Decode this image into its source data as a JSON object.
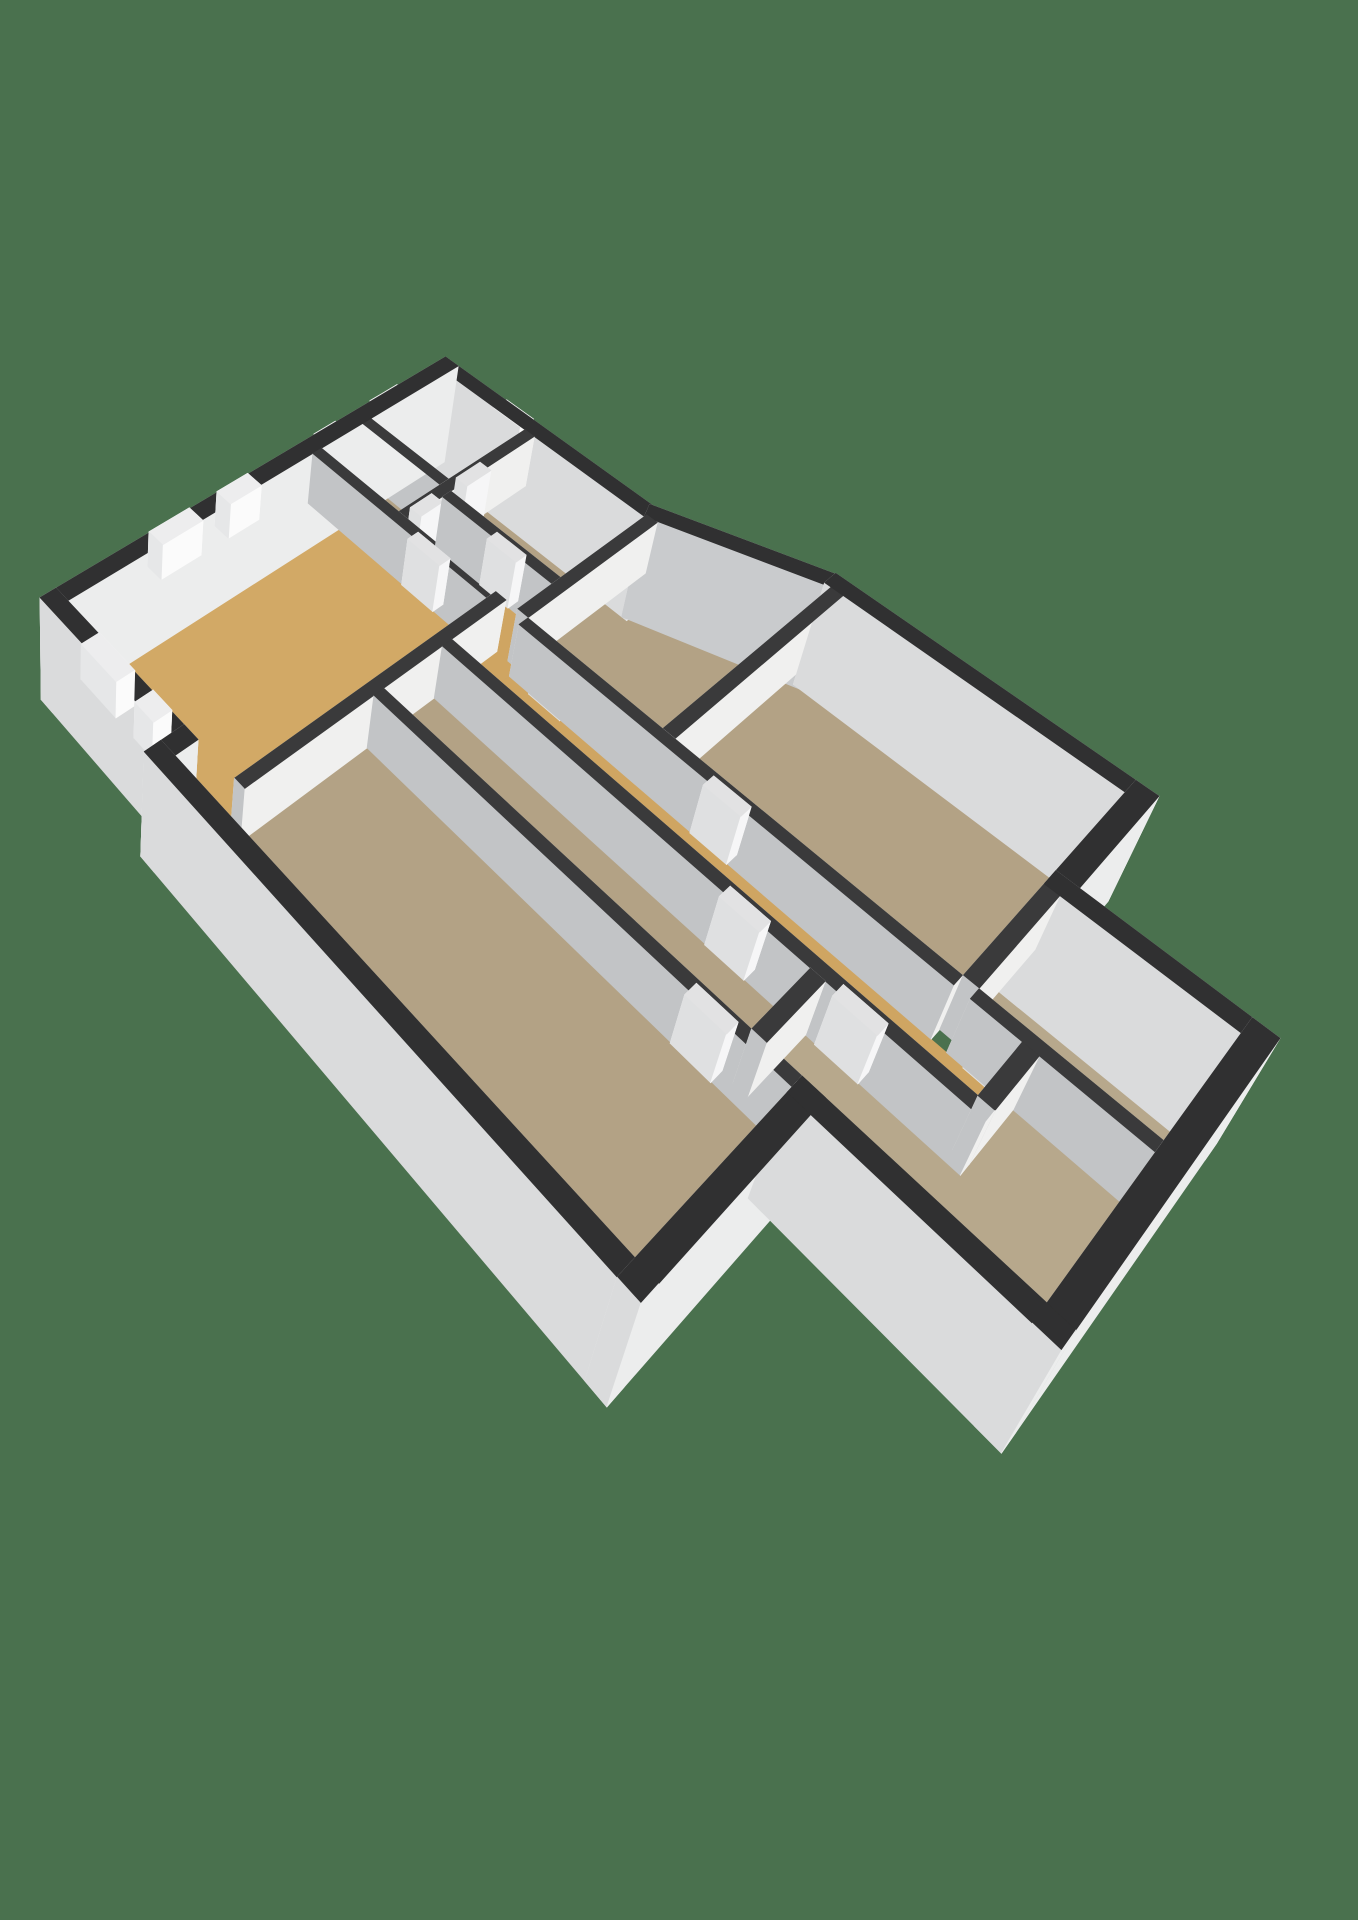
{
  "background_color": "#4a714e",
  "canvas": {
    "width": 1358,
    "height": 1920
  },
  "camera": {
    "yaw_deg": 36.9,
    "pitch_deg": 39.5,
    "distance": 28,
    "focal": 1000,
    "fit": {
      "x": 40,
      "y": 350,
      "w": 1240,
      "h": 1110,
      "max_stretch": 1.3
    }
  },
  "heights": {
    "wall_top": 0.93,
    "ext_bottom": -0.95,
    "int_bottom": 0,
    "window_z": [
      0.3,
      0.93
    ],
    "door_z": [
      0,
      0.84
    ],
    "entrance_z": [
      0,
      0.93
    ]
  },
  "palette": {
    "floor": {
      "gold": "#d2a966",
      "gold_corridor": "#cfa562",
      "tan": "#b3a285",
      "tan_light": "#b7a88c"
    },
    "ext": {
      "NW": "#f0f0ef",
      "NE": "#c9cbcd",
      "SE": "#eceded",
      "SW": "#dadbdc",
      "cap": "#303031"
    },
    "int": {
      "NW": "#e8e8e7",
      "NE": "#f5f5f4",
      "SE": "#f0f0ef",
      "SW": "#c2c4c6",
      "cap": "#3a3a3b"
    },
    "window": {
      "side": "#fbfbfb",
      "cap": "#ededee"
    },
    "door": {
      "side": "#f6f6f7",
      "cap": "#e2e2e3"
    }
  },
  "floors": [
    {
      "id": "floor-living-room",
      "color": "gold",
      "pts": [
        [
          0,
          0
        ],
        [
          6.1,
          0
        ],
        [
          6.1,
          4.5
        ],
        [
          0,
          4.5
        ]
      ]
    },
    {
      "id": "floor-room-north-a",
      "color": "tan",
      "pts": [
        [
          6.34,
          0
        ],
        [
          7.5,
          0
        ],
        [
          7.5,
          2.1
        ],
        [
          6.34,
          2.1
        ]
      ]
    },
    {
      "id": "floor-room-north-b",
      "color": "tan",
      "pts": [
        [
          7.74,
          0
        ],
        [
          10,
          0
        ],
        [
          10,
          2.1
        ],
        [
          7.74,
          2.1
        ]
      ]
    },
    {
      "id": "floor-corridor-neck",
      "color": "gold_corridor",
      "pts": [
        [
          6.34,
          2.34
        ],
        [
          7.3,
          2.34
        ],
        [
          7.3,
          5.0
        ],
        [
          6.34,
          5.0
        ]
      ]
    },
    {
      "id": "floor-office-north",
      "color": "tan",
      "pts": [
        [
          7.54,
          2.34
        ],
        [
          10,
          2.34
        ],
        [
          10,
          5.0
        ],
        [
          7.54,
          5.0
        ]
      ]
    },
    {
      "id": "floor-corridor-elbow",
      "color": "gold_corridor",
      "pts": [
        [
          4.9,
          4.74
        ],
        [
          6.34,
          4.74
        ],
        [
          6.34,
          5.24
        ],
        [
          4.9,
          5.24
        ]
      ]
    },
    {
      "id": "floor-corridor-main",
      "color": "gold_corridor",
      "pts": [
        [
          4.9,
          5.24
        ],
        [
          6.1,
          5.24
        ],
        [
          6.1,
          13.3
        ],
        [
          4.9,
          13.3
        ]
      ]
    },
    {
      "id": "floor-corridor-south",
      "color": "gold_corridor",
      "pts": [
        [
          4.9,
          13.3
        ],
        [
          6.1,
          13.3
        ],
        [
          6.1,
          14.3
        ],
        [
          4.9,
          14.3
        ]
      ]
    },
    {
      "id": "floor-office-east-1",
      "color": "tan",
      "pts": [
        [
          6.34,
          5.24
        ],
        [
          10.1,
          5.24
        ],
        [
          11.3,
          8.1
        ],
        [
          6.34,
          8.1
        ]
      ]
    },
    {
      "id": "floor-office-east-2",
      "color": "tan",
      "pts": [
        [
          6.34,
          8.34
        ],
        [
          11.3,
          8.34
        ],
        [
          11.3,
          13.3
        ],
        [
          6.34,
          13.3
        ]
      ]
    },
    {
      "id": "floor-room-long-a",
      "color": "tan",
      "pts": [
        [
          3.2,
          4.74
        ],
        [
          4.66,
          4.74
        ],
        [
          4.66,
          11.9
        ],
        [
          3.2,
          11.9
        ]
      ]
    },
    {
      "id": "floor-room-long-b",
      "color": "tan",
      "pts": [
        [
          -0.5,
          3.6
        ],
        [
          0,
          3.6
        ],
        [
          0,
          4.74
        ],
        [
          2.96,
          4.74
        ],
        [
          2.96,
          12.7
        ],
        [
          -0.5,
          12.7
        ]
      ]
    },
    {
      "id": "floor-room-south-big",
      "color": "tan_light",
      "pts": [
        [
          3.2,
          11.9
        ],
        [
          4.66,
          11.9
        ],
        [
          4.66,
          14.54
        ],
        [
          6.1,
          14.54
        ],
        [
          6.1,
          16.1
        ],
        [
          3.2,
          16.1
        ]
      ]
    },
    {
      "id": "floor-room-south-east",
      "color": "tan_light",
      "pts": [
        [
          6.34,
          13.54
        ],
        [
          8.7,
          13.54
        ],
        [
          8.7,
          16.1
        ],
        [
          6.34,
          16.1
        ]
      ]
    }
  ],
  "ext_walls": [
    {
      "id": "ext-wall-nw",
      "r": [
        -0.36,
        -0.36,
        10.36,
        0
      ]
    },
    {
      "id": "ext-wall-ne-north",
      "r": [
        10,
        0,
        10.36,
        5.12
      ]
    },
    {
      "id": "ext-wall-ne-angled",
      "poly": [
        [
          10,
          5.0
        ],
        [
          11.3,
          8.1
        ],
        [
          11.64,
          7.97
        ],
        [
          10.34,
          4.87
        ]
      ]
    },
    {
      "id": "ext-wall-ne-east",
      "r": [
        11.3,
        7.97,
        11.66,
        13.66
      ]
    },
    {
      "id": "ext-wall-se-notch",
      "r": [
        8.7,
        13.3,
        11.66,
        13.66
      ]
    },
    {
      "id": "ext-wall-wing-ne",
      "r": [
        8.7,
        13.3,
        9.06,
        16.46
      ]
    },
    {
      "id": "ext-wall-wing-se",
      "r": [
        2.84,
        16.1,
        9.06,
        16.46
      ]
    },
    {
      "id": "ext-wall-wing-sw",
      "r": [
        2.84,
        12.7,
        3.2,
        16.46
      ]
    },
    {
      "id": "ext-wall-kblock-se",
      "r": [
        -0.86,
        12.7,
        3.2,
        13.06
      ]
    },
    {
      "id": "ext-wall-sw-long",
      "r": [
        -0.86,
        3.24,
        -0.5,
        13.06
      ]
    },
    {
      "id": "ext-wall-sw-jog",
      "r": [
        -0.86,
        3.24,
        0,
        3.6
      ]
    },
    {
      "id": "ext-wall-sw-north",
      "r": [
        -0.36,
        -0.36,
        0,
        3.6
      ]
    }
  ],
  "int_walls": [
    {
      "id": "int-wall-1",
      "r": [
        0,
        4.5,
        6.34,
        4.74
      ]
    },
    {
      "id": "int-wall-2",
      "r": [
        6.1,
        0,
        6.34,
        4.5
      ]
    },
    {
      "id": "int-wall-3",
      "r": [
        6.34,
        2.1,
        10,
        2.34
      ]
    },
    {
      "id": "int-wall-4",
      "r": [
        7.5,
        0,
        7.74,
        2.1
      ]
    },
    {
      "id": "int-wall-5",
      "r": [
        7.3,
        2.34,
        7.54,
        5.0
      ]
    },
    {
      "id": "int-wall-6",
      "r": [
        6.34,
        5.0,
        10.07,
        5.24
      ]
    },
    {
      "id": "int-wall-7",
      "r": [
        6.1,
        5.24,
        6.34,
        13.3
      ]
    },
    {
      "id": "int-wall-8",
      "r": [
        6.34,
        8.1,
        11.3,
        8.34
      ]
    },
    {
      "id": "int-wall-9",
      "r": [
        4.66,
        4.74,
        4.9,
        14.54
      ]
    },
    {
      "id": "int-wall-10",
      "r": [
        3.2,
        11.9,
        4.66,
        12.14
      ]
    },
    {
      "id": "int-wall-11",
      "r": [
        2.96,
        4.74,
        3.2,
        12.7
      ]
    },
    {
      "id": "int-wall-12",
      "r": [
        6.34,
        13.3,
        8.7,
        13.54
      ]
    },
    {
      "id": "int-wall-13",
      "r": [
        6.1,
        13.54,
        6.34,
        16.1
      ]
    },
    {
      "id": "int-wall-14",
      "r": [
        4.9,
        14.3,
        6.1,
        14.54
      ]
    }
  ],
  "windows": [
    {
      "id": "window-1",
      "r": [
        2.2,
        -0.38,
        3.2,
        0.02
      ]
    },
    {
      "id": "window-2",
      "r": [
        3.9,
        -0.38,
        4.7,
        0.02
      ]
    },
    {
      "id": "window-3",
      "r": [
        6.5,
        -0.38,
        7.1,
        0.02
      ]
    },
    {
      "id": "window-4",
      "r": [
        8.1,
        -0.38,
        8.9,
        0.02
      ]
    },
    {
      "id": "window-5",
      "r": [
        -0.38,
        0.9,
        0.02,
        1.9
      ]
    },
    {
      "id": "window-6",
      "r": [
        -0.38,
        2.4,
        0.02,
        2.9
      ]
    }
  ],
  "entrance": {
    "id": "entrance-door",
    "r": [
      9.98,
      1.3,
      10.38,
      2.0
    ]
  },
  "doors": [
    {
      "id": "door-1",
      "r": [
        6.08,
        2.6,
        6.36,
        3.4
      ]
    },
    {
      "id": "door-2",
      "r": [
        7.28,
        3.5,
        7.56,
        4.2
      ]
    },
    {
      "id": "door-3",
      "r": [
        6.08,
        5.7,
        6.36,
        6.4
      ]
    },
    {
      "id": "door-4",
      "r": [
        6.08,
        9.1,
        6.36,
        9.8
      ]
    },
    {
      "id": "door-5",
      "r": [
        4.64,
        10.4,
        4.92,
        11.1
      ]
    },
    {
      "id": "door-6",
      "r": [
        4.64,
        12.3,
        4.92,
        13.0
      ]
    },
    {
      "id": "door-7",
      "r": [
        2.94,
        11.0,
        3.22,
        11.7
      ]
    },
    {
      "id": "door-8",
      "r": [
        6.08,
        13.8,
        6.36,
        14.4
      ]
    },
    {
      "id": "door-9",
      "r": [
        8.0,
        2.08,
        8.7,
        2.36
      ]
    },
    {
      "id": "door-10",
      "r": [
        6.7,
        2.08,
        7.3,
        2.36
      ]
    }
  ],
  "stairs_icons": [
    {
      "id": "stairs-icon-corridor",
      "x": 5.2,
      "y": 9.1,
      "w": 0.6,
      "steps": 4,
      "dy": 0.2,
      "color": "#f2f2f2"
    },
    {
      "id": "stairs-icon-entrance",
      "x": 10.46,
      "y": 2.05,
      "w": 0.55,
      "steps": 4,
      "dy": 0.17,
      "color": "#f4f4f4"
    }
  ]
}
